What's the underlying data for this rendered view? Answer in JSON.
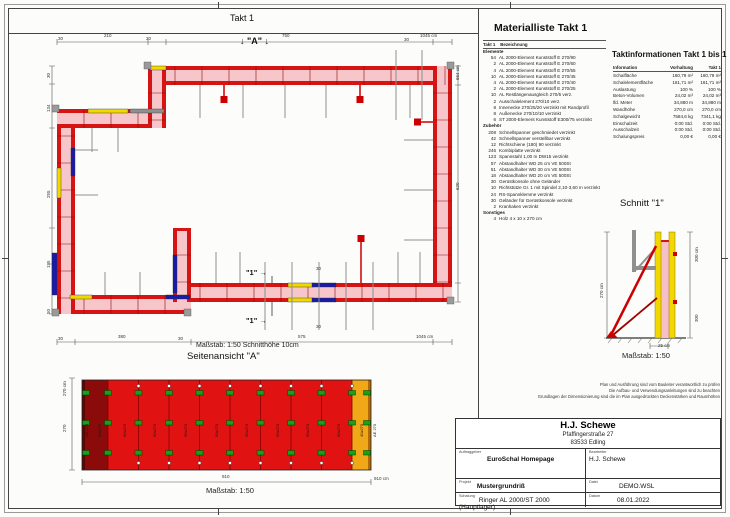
{
  "header": {
    "takt_label": "Takt 1"
  },
  "plan": {
    "marker_a": "↓ \"A\" ↓",
    "marker_1": "\"1\" →",
    "masstab": "Maßstab: 1:50   Schnitthöhe 10cm",
    "dims": [
      {
        "t": "30",
        "x": 58,
        "y": 36
      },
      {
        "t": "210",
        "x": 104,
        "y": 33
      },
      {
        "t": "30",
        "x": 146,
        "y": 36
      },
      {
        "t": "750",
        "x": 282,
        "y": 33
      },
      {
        "t": "30",
        "x": 404,
        "y": 37
      },
      {
        "t": "1045 cm",
        "x": 420,
        "y": 33
      },
      {
        "t": "30",
        "x": 46,
        "y": 78,
        "r": 1
      },
      {
        "t": "134",
        "x": 46,
        "y": 112,
        "r": 1
      },
      {
        "t": "255",
        "x": 46,
        "y": 198,
        "r": 1
      },
      {
        "t": "195",
        "x": 46,
        "y": 268,
        "r": 1
      },
      {
        "t": "50",
        "x": 46,
        "y": 314,
        "r": 1
      },
      {
        "t": "664 cm",
        "x": 455,
        "y": 80,
        "r": 1
      },
      {
        "t": "620",
        "x": 455,
        "y": 190,
        "r": 1
      },
      {
        "t": "30",
        "x": 58,
        "y": 336
      },
      {
        "t": "380",
        "x": 118,
        "y": 334
      },
      {
        "t": "30",
        "x": 178,
        "y": 336
      },
      {
        "t": "575",
        "x": 298,
        "y": 334
      },
      {
        "t": "1045 cm",
        "x": 416,
        "y": 334
      },
      {
        "t": "30",
        "x": 316,
        "y": 266
      },
      {
        "t": "30",
        "x": 316,
        "y": 324
      }
    ]
  },
  "side_view": {
    "title": "Seitenansicht \"A\"",
    "masstab": "Maßstab: 1:50",
    "dims": [
      {
        "t": "270 cm",
        "x": 62,
        "y": 396,
        "r": 1
      },
      {
        "t": "270",
        "x": 62,
        "y": 432,
        "r": 1
      },
      {
        "t": "910",
        "x": 222,
        "y": 474
      },
      {
        "t": "910 cm",
        "x": 374,
        "y": 476
      }
    ],
    "panels": [
      {
        "label": "AE 270",
        "x": 84
      },
      {
        "label": "90x270",
        "x": 97
      },
      {
        "label": "90x270",
        "x": 122
      },
      {
        "label": "90x270",
        "x": 152
      },
      {
        "label": "90x270",
        "x": 183
      },
      {
        "label": "90x270",
        "x": 214
      },
      {
        "label": "90x270",
        "x": 244
      },
      {
        "label": "90x270",
        "x": 275
      },
      {
        "label": "90x270",
        "x": 305
      },
      {
        "label": "90x270",
        "x": 336
      },
      {
        "label": "40x270",
        "x": 359
      },
      {
        "label": "AE 270",
        "x": 372
      }
    ]
  },
  "schnitt": {
    "title": "Schnitt  \"1\"",
    "masstab": "Maßstab: 1:50",
    "dims": [
      {
        "t": "270 cm",
        "x": 599,
        "y": 298,
        "r": 1
      },
      {
        "t": "300 cm",
        "x": 694,
        "y": 262,
        "r": 1
      },
      {
        "t": "300",
        "x": 694,
        "y": 322,
        "r": 1
      },
      {
        "t": "25 cm",
        "x": 658,
        "y": 343
      }
    ]
  },
  "materialliste": {
    "title": "Materialliste  Takt 1",
    "col_takt": "Takt 1",
    "col_bez": "Bezeichnung",
    "sections": [
      {
        "name": "Elemente",
        "items": [
          {
            "qty": "54",
            "text": "AL 2000-Element Kunststoff E 270/90"
          },
          {
            "qty": "2",
            "text": "AL 2000-Element Kunststoff E 270/60"
          },
          {
            "qty": "4",
            "text": "AL 2000-Element Kunststoff E 270/55"
          },
          {
            "qty": "10",
            "text": "AL 2000-Element Kunststoff E 270/45"
          },
          {
            "qty": "4",
            "text": "AL 2000-Element Kunststoff E 270/40"
          },
          {
            "qty": "2",
            "text": "AL 2000-Element Kunststoff E 270/25"
          },
          {
            "qty": "10",
            "text": "AL Restlängenausgleich 270/5 verz."
          },
          {
            "qty": "2",
            "text": "Ausschalelement 270/10 verz."
          },
          {
            "qty": "8",
            "text": "Innenecke 270/25/20 verzinkt mit Randprofil"
          },
          {
            "qty": "8",
            "text": "Außenecke 270/10/10 verzinkt"
          },
          {
            "qty": "6",
            "text": "ST 2000-Element Kunststoff E300/75 verzinkt"
          }
        ]
      },
      {
        "name": "Zubehör",
        "items": [
          {
            "qty": "208",
            "text": "Schnellspanner geschmiedet verzinkt"
          },
          {
            "qty": "42",
            "text": "Schnellspanner verstellbar verzinkt"
          },
          {
            "qty": "12",
            "text": "Richtschiene (180) 90 verzinkt"
          },
          {
            "qty": "246",
            "text": "Kombiplatte verzinkt"
          },
          {
            "qty": "123",
            "text": "Spannstahl 1,00 m DW15 verzinkt"
          },
          {
            "qty": "57",
            "text": "Abstandhalter WD 25 cm VE 500St"
          },
          {
            "qty": "51",
            "text": "Abstandhalter WD 30 cm VE 500St"
          },
          {
            "qty": "18",
            "text": "Abstandhalter WD 20 cm VE 500St"
          },
          {
            "qty": "30",
            "text": "Gerüstkonsole ohne Geländer"
          },
          {
            "qty": "10",
            "text": "Richtstütze Gr. 1 mit Spindel 2,10-3,60 m verzinkt"
          },
          {
            "qty": "24",
            "text": "RS-Spannklemme verzinkt"
          },
          {
            "qty": "30",
            "text": "Geländer für Gerüstkonsole verzinkt"
          },
          {
            "qty": "2",
            "text": "Kranhaken verzinkt"
          }
        ]
      },
      {
        "name": "Sonstiges",
        "items": [
          {
            "qty": "4",
            "text": "Holz 4 x 10 x 270 cm"
          }
        ]
      }
    ]
  },
  "taktinfo": {
    "title": "Taktinformationen  Takt 1 bis 1",
    "columns": [
      "Information",
      "Vorhaltung",
      "Takt 1"
    ],
    "rows": [
      [
        "Schalfläche",
        "160,79 m²",
        "160,79 m²"
      ],
      [
        "Schalelementfläche",
        "161,71 m²",
        "161,71 m²"
      ],
      [
        "Auslastung",
        "100 %",
        "100 %"
      ],
      [
        "Beton-Volumen",
        "24,02 m³",
        "24,02 m³"
      ],
      [
        "lfd. Meter",
        "34,880 m",
        "34,880 m"
      ],
      [
        "Wandhöhe",
        "270,0 cm",
        "270,0 cm"
      ],
      [
        "Schalgewicht",
        "7584,6 kg",
        "7341,1 kg"
      ],
      [
        "Einschalzeit",
        "0:00 Std.",
        "0:00 Std."
      ],
      [
        "Ausschalzeit",
        "0:00 Std.",
        "0:00 Std."
      ],
      [
        "Schalungspreis",
        "0,00 €",
        "0,00 €"
      ]
    ]
  },
  "disclaimer": [
    "Plan und Ausführung sind vom Bauleiter verantwortlich zu prüfen",
    "Die Aufbau- und Verwendungsanleitungen sind zu beachten",
    "Grundlagen der Dimensionierung sind die im Plan ausgedrückten Deckenstärken und Raumhöhen"
  ],
  "titleblock": {
    "company": "H.J. Schewe",
    "address1": "Pfaffingerstraße 27",
    "address2": "83533 Edling",
    "auftraggeber_label": "Auftraggeber",
    "auftraggeber": "EuroSchal Homepage",
    "bearbeiter_label": "Bearbeiter",
    "bearbeiter": "H.J. Schewe",
    "projekt_label": "Projekt",
    "projekt": "Mustergrundriß",
    "datei_label": "Datei",
    "datei": "DEMO.WSL",
    "schalung_label": "Schalung",
    "schalung": "Ringer AL 2000/ST 2000 (Hauptlager)",
    "datum_label": "Datum",
    "datum": "08.01.2022"
  },
  "colors": {
    "formwork_red": "#d61414",
    "concrete_pink": "#f6c6ca",
    "element_yellow": "#f2d800",
    "element_blue": "#1a1aa6",
    "element_orange": "#f0a818",
    "clamp_green": "#18a018",
    "brace_gray": "#8f8f8f",
    "dark_red": "#8b0a0a"
  }
}
